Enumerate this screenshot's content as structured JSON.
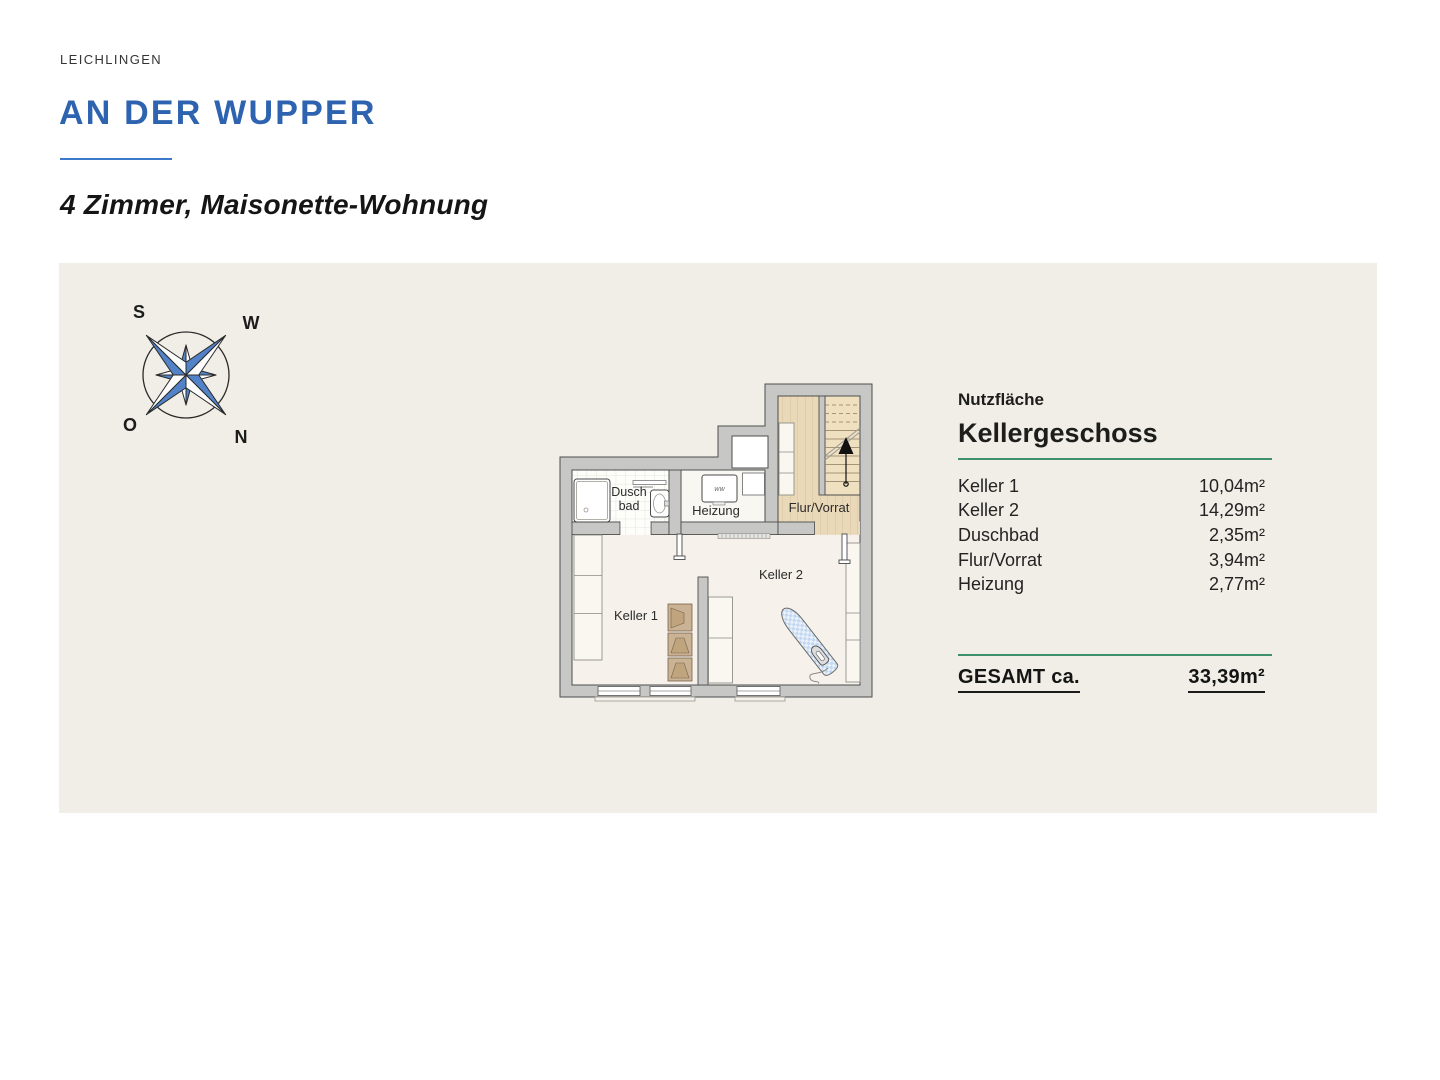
{
  "header": {
    "location": "LEICHLINGEN",
    "title": "AN DER WUPPER",
    "subtitle": "4 Zimmer, Maisonette-Wohnung"
  },
  "compass": {
    "south": "S",
    "west": "W",
    "east": "O",
    "north": "N"
  },
  "floorplan": {
    "room_labels": {
      "duschbad_line1": "Dusch",
      "duschbad_line2": "bad",
      "heizung": "Heizung",
      "flur_vorrat": "Flur/Vorrat",
      "keller1": "Keller 1",
      "keller2": "Keller 2",
      "boiler": "WW"
    }
  },
  "area_table": {
    "section_label": "Nutzfläche",
    "floor_title": "Kellergeschoss",
    "rows": [
      {
        "label": "Keller 1",
        "value": "10,04m²"
      },
      {
        "label": "Keller 2",
        "value": "14,29m²"
      },
      {
        "label": "Duschbad",
        "value": "2,35m²"
      },
      {
        "label": "Flur/Vorrat",
        "value": "3,94m²"
      },
      {
        "label": "Heizung",
        "value": "2,77m²"
      }
    ],
    "total_label": "GESAMT ca.",
    "total_value": "33,39m²"
  },
  "colors": {
    "accent-blue": "#2e63b0",
    "underline-blue": "#3c79c9",
    "rule-green": "#3e8f6e",
    "panel-bg": "#f0eee6",
    "compass-blue": "#5282c8",
    "wall-gray": "#c7c7c6"
  }
}
